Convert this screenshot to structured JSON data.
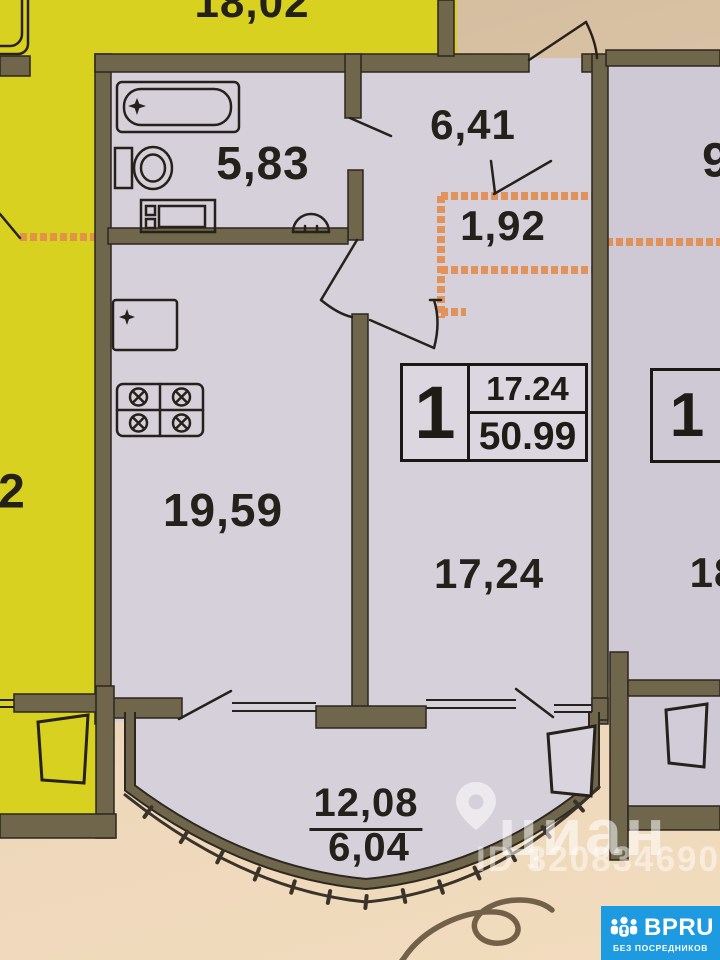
{
  "colors": {
    "paper": "#e6cfb2",
    "unit_floor": "#d6d0da",
    "adjacent_floor_yellow": "#d9d11f",
    "wall": "#6f664b",
    "line": "#26221b",
    "orange_marking": "#e28c4c",
    "watermark": "rgba(255,255,255,0.55)",
    "badge_blue": "#1e9be0"
  },
  "plan": {
    "main_unit": {
      "bathroom_area": "5,83",
      "hallway_area": "6,41",
      "wardrobe_area": "1,92",
      "kitchen_living_area": "19,59",
      "room_area": "17,24",
      "balcony_area_full": "12,08",
      "balcony_area_counted": "6,04",
      "info_box": {
        "rooms": "1",
        "living_area": "17.24",
        "total_area": "50.99"
      }
    },
    "left_unit": {
      "top_room_area_partial": "18,02",
      "room_area_partial": "2"
    },
    "right_unit": {
      "hallway_area_partial": "9",
      "room_area_partial": "18",
      "info_box_rooms": "1"
    }
  },
  "watermark": {
    "brand": "циан",
    "listing_id": "ID 320834690"
  },
  "badge": {
    "brand": "BPRU",
    "tagline": "БЕЗ ПОСРЕДНИКОВ"
  }
}
